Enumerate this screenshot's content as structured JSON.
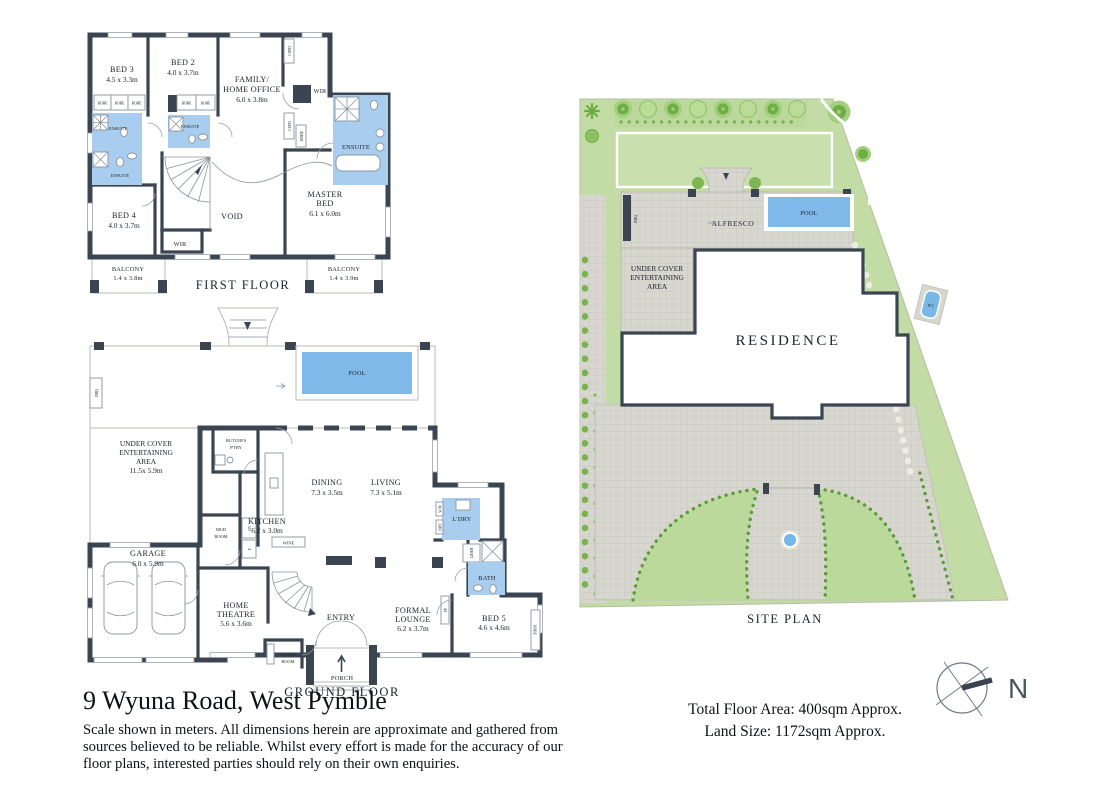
{
  "meta": {
    "address": "9 Wyuna Road, West Pymble",
    "disclaimer1": "Scale shown in meters. All dimensions herein are approximate and gathered from",
    "disclaimer2": "sources believed to be reliable. Whilst every effort is made for the accuracy of our",
    "disclaimer3": "floor plans, interested parties should rely on their own enquiries.",
    "total_floor_area": "Total Floor Area: 400sqm Approx.",
    "land_size": "Land Size: 1172sqm Approx.",
    "north": "N"
  },
  "titles": {
    "first_floor": "FIRST FLOOR",
    "ground_floor": "GROUND FLOOR",
    "site_plan": "SITE PLAN"
  },
  "labels": {
    "robe": "ROBE",
    "cupd": "CUPD",
    "wir": "WIR",
    "ensuite": "ENSUITE",
    "void": "VOID",
    "wine": "WINE",
    "linen": "LINEN",
    "bbq": "BBQ",
    "fp": "FP",
    "wt": "WT",
    "ov": "OV",
    "f": "F",
    "wm": "W/M",
    "dry": "DRY",
    "pool": "POOL",
    "alfresco": "ALFRESCO",
    "residence": "RESIDENCE",
    "entry": "ENTRY",
    "porch": "PORCH",
    "bath": "BATH",
    "ldry": "L'DRY",
    "mud1": "MUD",
    "mud2": "ROOM",
    "cloak1": "CLOAK",
    "cloak2": "ROOM",
    "butlers1": "BUTLER'S",
    "butlers2": "P'TRY"
  },
  "ff": {
    "bed3": {
      "name": "BED 3",
      "dims": "4.5 x 3.3m"
    },
    "bed2": {
      "name": "BED 2",
      "dims": "4.0 x 3.7m"
    },
    "family": {
      "l1": "FAMILY/",
      "l2": "HOME OFFICE",
      "dims": "6.0 x 3.8m"
    },
    "bed4": {
      "name": "BED 4",
      "dims": "4.0 x 3.7m"
    },
    "master": {
      "l1": "MASTER",
      "l2": "BED",
      "dims": "6.1 x 6.0m"
    },
    "balcony_left": {
      "name": "BALCONY",
      "dims": "1.4 x 3.8m"
    },
    "balcony_right": {
      "name": "BALCONY",
      "dims": "1.4 x 3.9m"
    }
  },
  "gf": {
    "alfresco": {
      "name": "ALFRESCO",
      "dims": "4.2 x 5.4m"
    },
    "ucea": {
      "l1": "UNDER COVER",
      "l2": "ENTERTAINING",
      "l3": "AREA",
      "dims": "11.5x 5.9m"
    },
    "kitchen": {
      "name": "KITCHEN",
      "dims": "6.2 x 3.0m"
    },
    "dining": {
      "name": "DINING",
      "dims": "7.3 x 3.5m"
    },
    "living": {
      "name": "LIVING",
      "dims": "7.3 x 5.1m"
    },
    "garage": {
      "name": "GARAGE",
      "dims": "6.0 x 5.9m"
    },
    "theatre": {
      "l1": "HOME",
      "l2": "THEATRE",
      "dims": "5.6 x 3.6m"
    },
    "lounge": {
      "l1": "FORMAL",
      "l2": "LOUNGE",
      "dims": "6.2 x 3.7m"
    },
    "bed5": {
      "name": "BED 5",
      "dims": "4.6 x 4.6m"
    }
  },
  "sp": {
    "ucea": {
      "l1": "UNDER COVER",
      "l2": "ENTERTAINING",
      "l3": "AREA"
    }
  },
  "colors": {
    "wall": "#3a4551",
    "wet_room": "#a9cdee",
    "pool": "#7fb9e9",
    "paving": "#dadad4",
    "site_green": "#c3dca6",
    "lawn": "#c9e0ae",
    "tree": "#6fae45",
    "hedge": "#5d9a3c",
    "text": "#20272e"
  }
}
